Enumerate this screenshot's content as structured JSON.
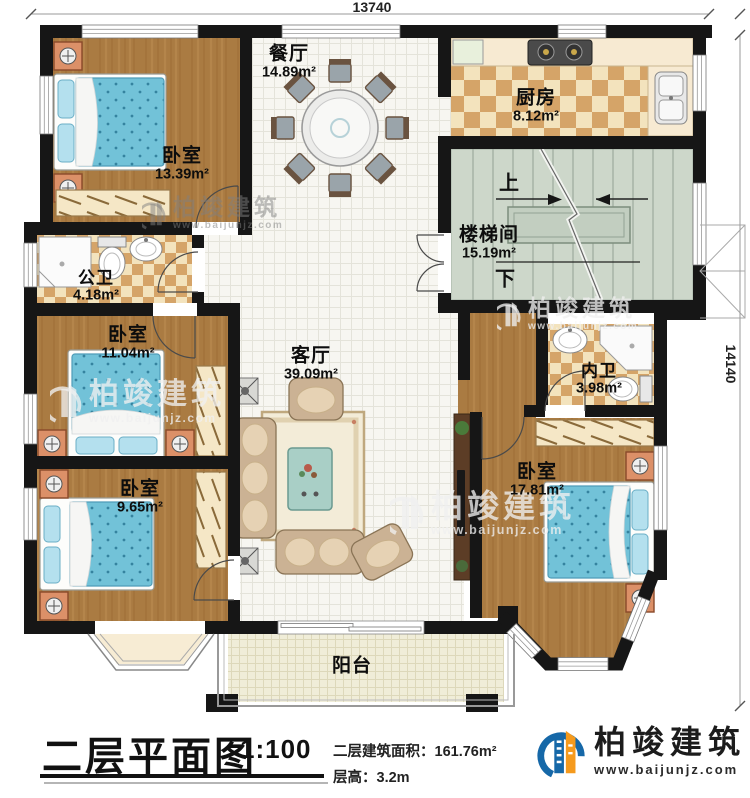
{
  "dimensions": {
    "width_mm": "13740",
    "height_mm": "14140"
  },
  "rooms": {
    "bedroom_top_left": {
      "name": "卧室",
      "area": "13.39m²"
    },
    "dining_room": {
      "name": "餐厅",
      "area": "14.89m²"
    },
    "kitchen": {
      "name": "厨房",
      "area": "8.12m²"
    },
    "stairwell": {
      "name": "楼梯间",
      "area": "15.19m²",
      "up_label": "上",
      "down_label": "下"
    },
    "public_bathroom": {
      "name": "公卫",
      "area": "4.18m²"
    },
    "bedroom_mid_left": {
      "name": "卧室",
      "area": "11.04m²"
    },
    "bedroom_bottom_left": {
      "name": "卧室",
      "area": "9.65m²"
    },
    "living_room": {
      "name": "客厅",
      "area": "39.09m²"
    },
    "inner_bathroom": {
      "name": "内卫",
      "area": "3.98m²"
    },
    "bedroom_right": {
      "name": "卧室",
      "area": "17.81m²"
    },
    "balcony": {
      "name": "阳台"
    }
  },
  "title_block": {
    "title": "二层平面图",
    "scale": "1:100",
    "area_info": "二层建筑面积：161.76m²",
    "floor_height": "层高：3.2m"
  },
  "branding": {
    "name": "柏竣建筑",
    "website": "www.baijunjz.com"
  },
  "watermark": {
    "name": "柏竣建筑",
    "website": "www.baijunjz.com"
  },
  "colors": {
    "wall": "#161616",
    "wood_floor": "#aa7b42",
    "tile_floor": "#f7f6f1",
    "checker_dark": "#d5a468",
    "checker_light": "#f3e3bd",
    "stair_floor": "#cdd7ca",
    "bed_fabric": "#72c2d8",
    "logo_blue": "#1668a8",
    "logo_orange": "#f59a1d"
  }
}
